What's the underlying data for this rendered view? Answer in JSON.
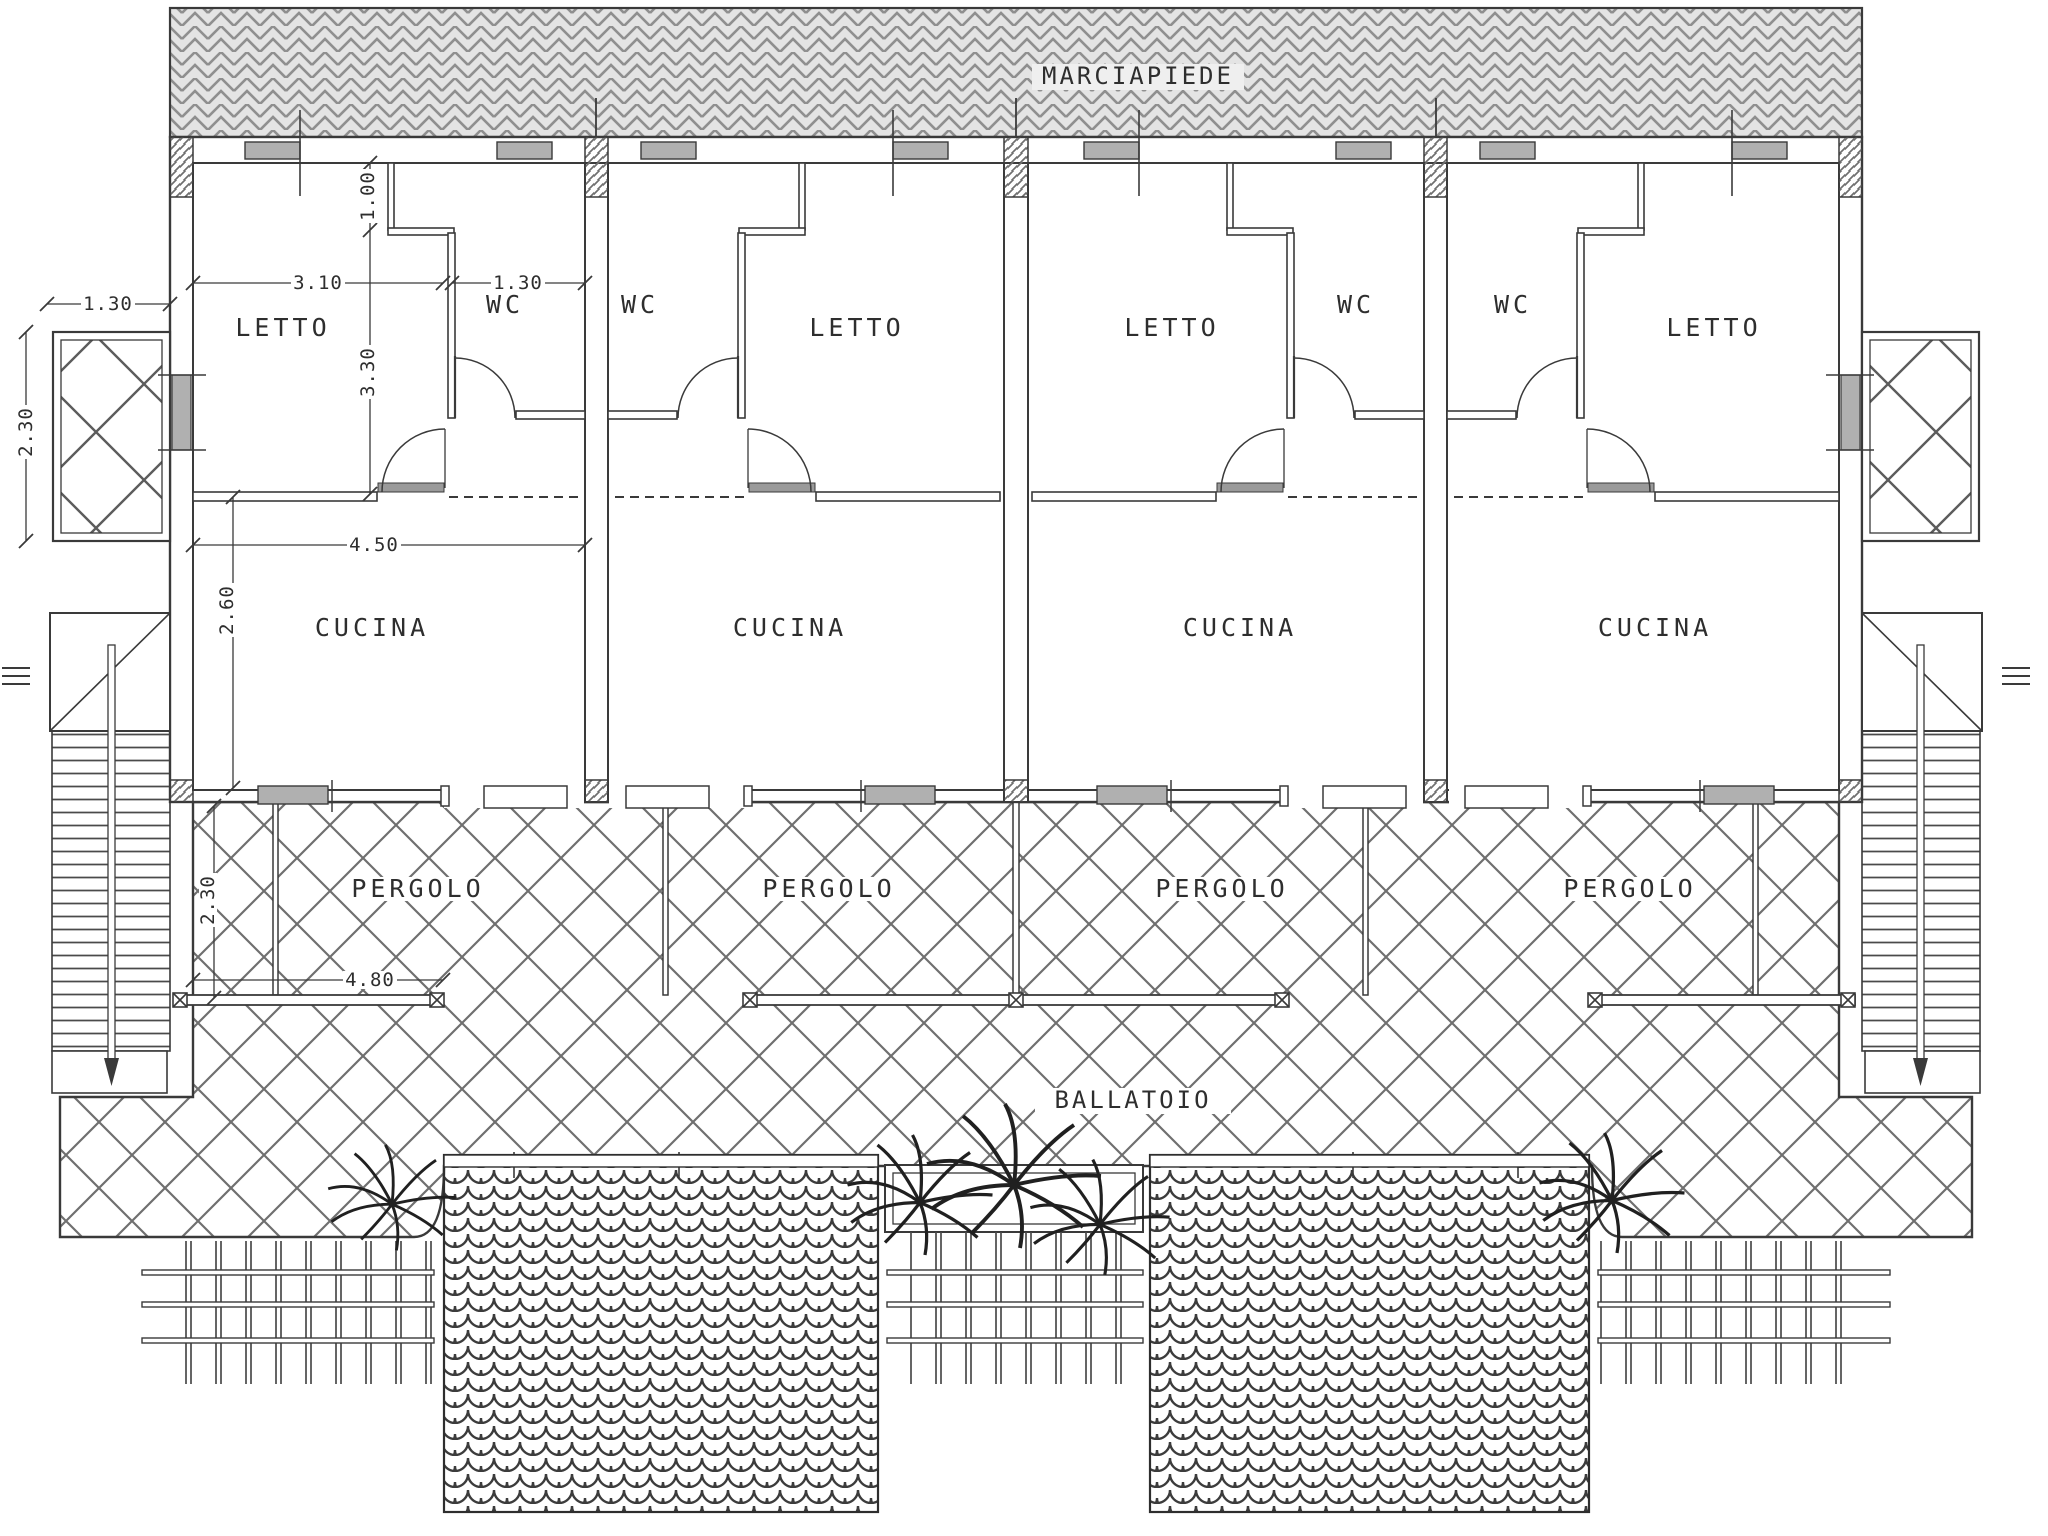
{
  "drawing": {
    "area_labels": {
      "marciapiede": "MARCIAPIEDE",
      "ballatoio": "BALLATOIO"
    },
    "units": [
      {
        "name": "unit-1",
        "letto": "LETTO",
        "wc": "WC",
        "cucina": "CUCINA",
        "pergolo": "PERGOLO"
      },
      {
        "name": "unit-2",
        "letto": "LETTO",
        "wc": "WC",
        "cucina": "CUCINA",
        "pergolo": "PERGOLO"
      },
      {
        "name": "unit-3",
        "letto": "LETTO",
        "wc": "WC",
        "cucina": "CUCINA",
        "pergolo": "PERGOLO"
      },
      {
        "name": "unit-4",
        "letto": "LETTO",
        "wc": "WC",
        "cucina": "CUCINA",
        "pergolo": "PERGOLO"
      }
    ],
    "dimensions": {
      "terrace_width": "1.30",
      "terrace_depth": "2.30",
      "letto_width": "3.10",
      "niche_depth": "1.00",
      "wc_width": "1.30",
      "letto_depth": "3.30",
      "cucina_width": "4.50",
      "cucina_depth": "2.60",
      "pergolo_width": "4.80",
      "pergolo_depth": "2.30"
    },
    "colors": {
      "line": "#3a3a3a",
      "hatch": "#6f6f6f",
      "glass": "#b0b0b0",
      "sidewalk_bg": "#e4e4e4",
      "paper": "#ffffff"
    }
  }
}
